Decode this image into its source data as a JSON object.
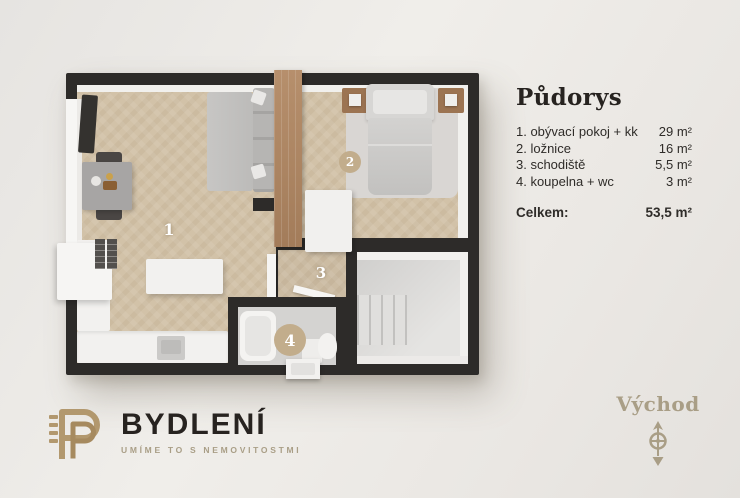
{
  "plan": {
    "labels": {
      "room1": "1",
      "room2": "2",
      "room3": "3",
      "room4": "4"
    }
  },
  "legend": {
    "title": "Půdorys",
    "items": [
      {
        "label": "1. obývací pokoj + kk",
        "area": "29 m²"
      },
      {
        "label": "2. ložnice",
        "area": "16 m²"
      },
      {
        "label": "3. schodiště",
        "area": "5,5 m²"
      },
      {
        "label": "4. koupelna + wc",
        "area": "3 m²"
      }
    ],
    "total_label": "Celkem:",
    "total_area": "53,5 m²"
  },
  "footer": {
    "brand": "BYDLENÍ",
    "tagline": "UMÍME TO S NEMOVITOSTMI"
  },
  "compass": {
    "direction": "Východ"
  },
  "colors": {
    "wall": "#2d2b29",
    "wood": "#d2c2a8",
    "gold": "#b2986e",
    "gold_muted": "#a99e86",
    "ink": "#272320",
    "badge": "#c2ad8c"
  }
}
